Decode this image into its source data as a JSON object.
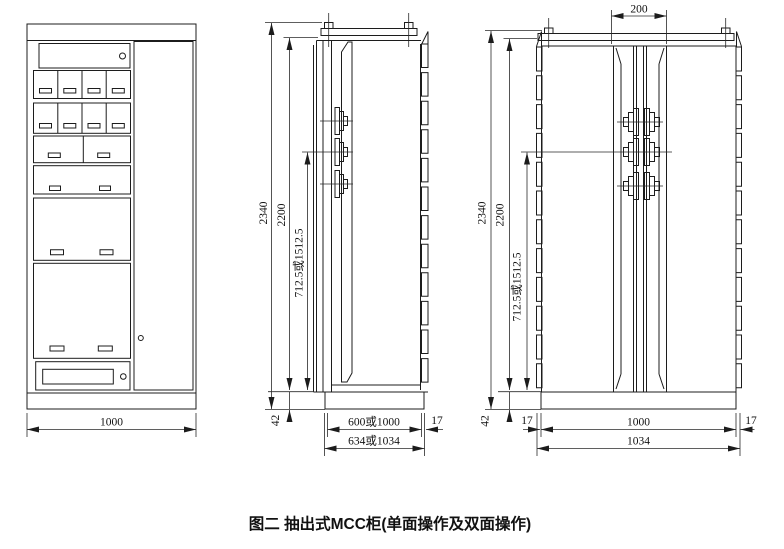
{
  "figure": {
    "caption": "图二 抽出式MCC柜(单面操作及双面操作)",
    "line_color": "#1c1c1c",
    "background": "#ffffff"
  },
  "front_view": {
    "width": "1000"
  },
  "side_view": {
    "total_height": "2340",
    "body_height": "2200",
    "busbar_height": "712.5或1512.5",
    "base_height": "42",
    "body_depth": "600或1000",
    "door_thickness": "17",
    "total_depth": "634或1034"
  },
  "double_view": {
    "busbar_spacing": "200",
    "total_height": "2340",
    "body_height": "2200",
    "busbar_height": "712.5或1512.5",
    "base_height": "42",
    "left_door_thickness": "17",
    "body_width": "1000",
    "right_door_thickness": "17",
    "total_width": "1034"
  }
}
